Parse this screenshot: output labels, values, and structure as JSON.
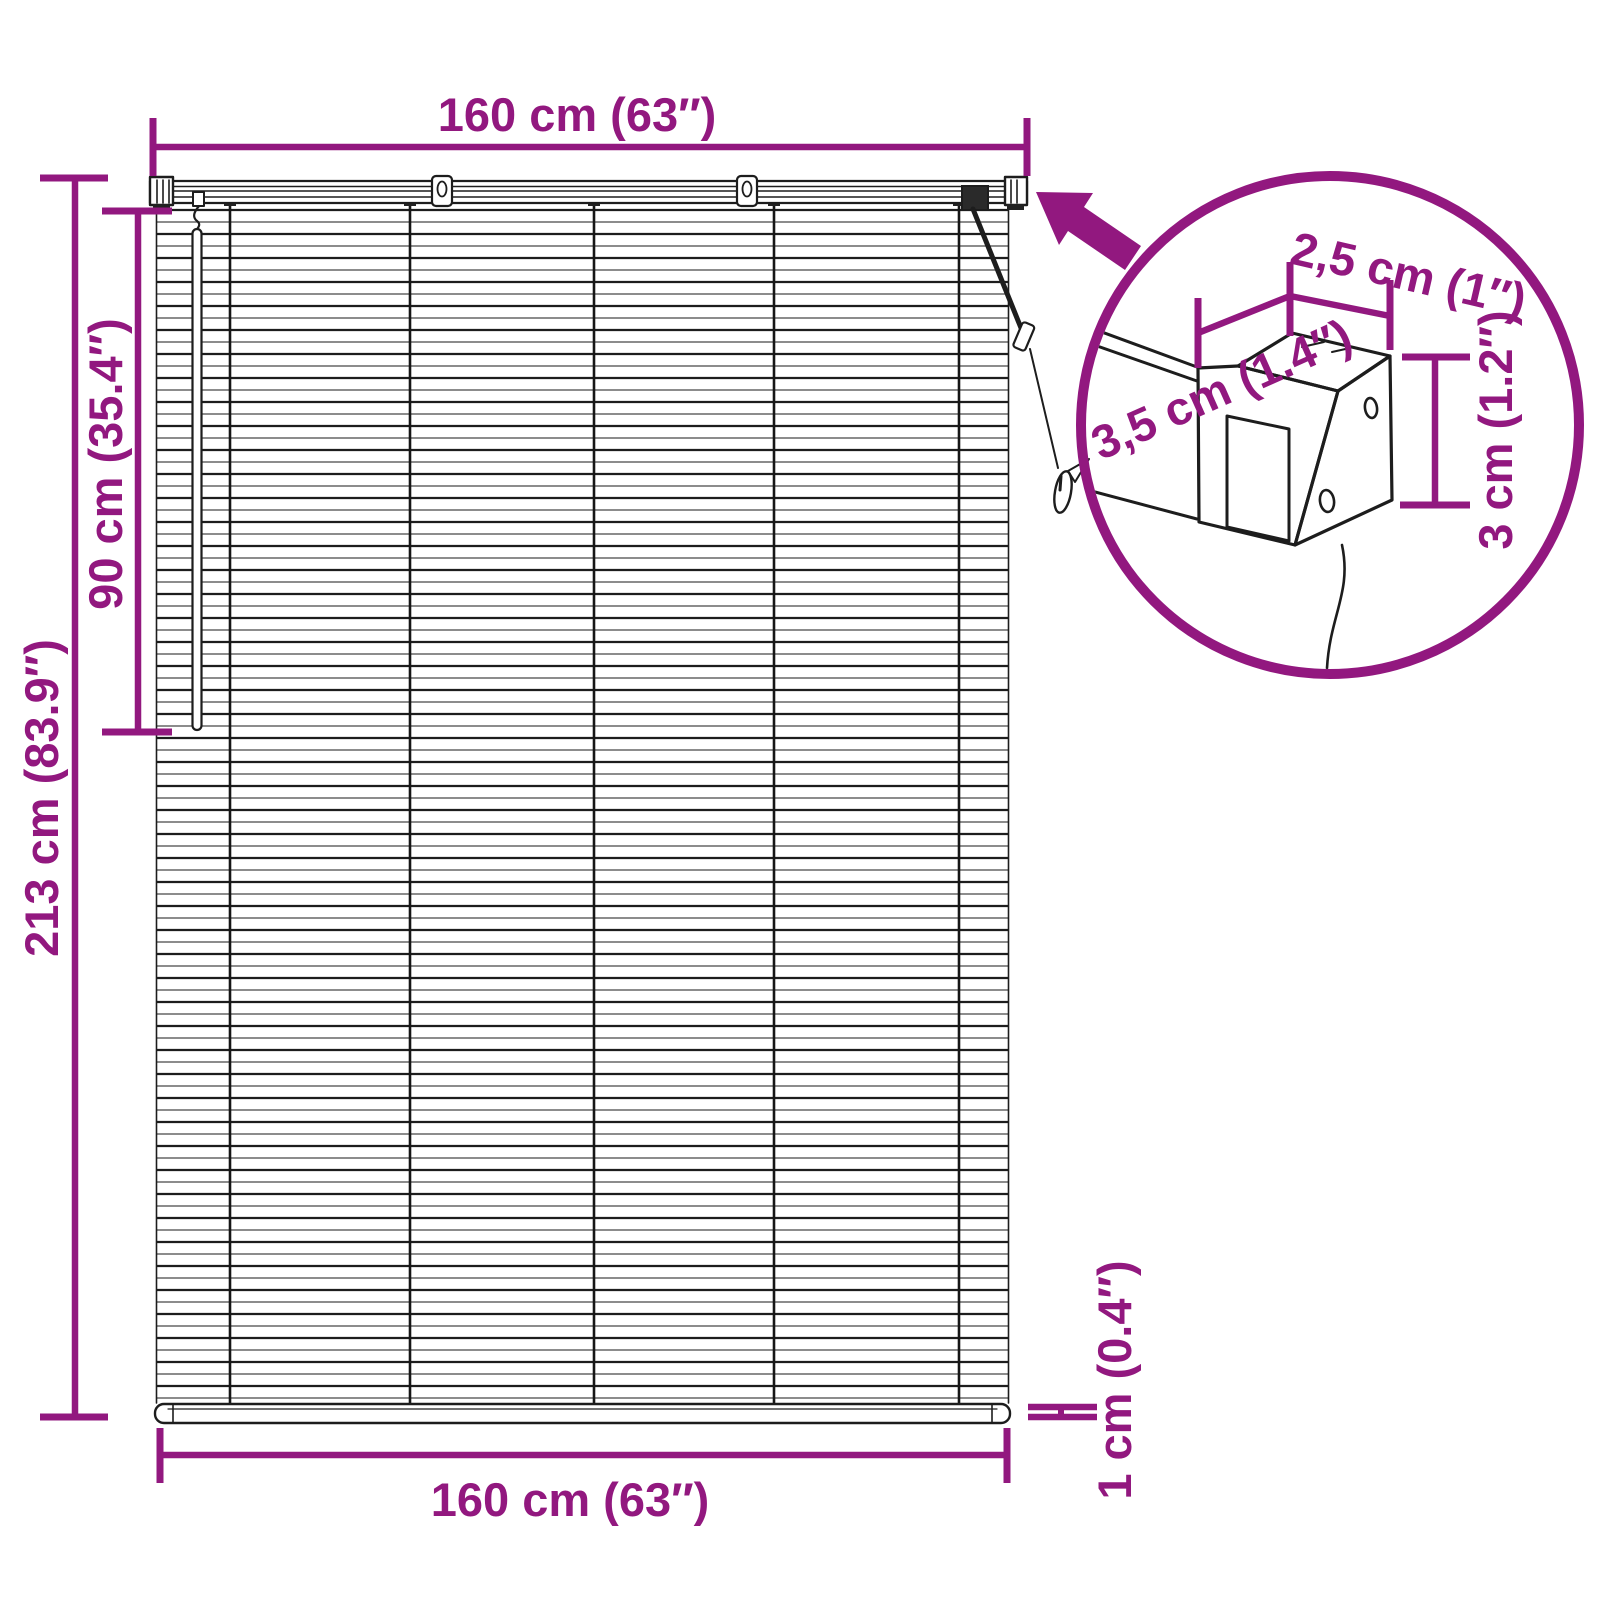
{
  "colors": {
    "accent": "#92187F",
    "line": "#1d1d1d"
  },
  "labels": {
    "top_width": "160 cm (63″)",
    "bottom_width": "160 cm (63″)",
    "total_height": "213 cm (83.9″)",
    "wand_length": "90 cm (35.4″)",
    "bottom_rail_thickness": "1 cm (0.4″)"
  },
  "inset": {
    "bracket_width": "2,5 cm (1″)",
    "bracket_depth": "3,5 cm (1.4″)",
    "bracket_height": "3 cm (1.2″)"
  }
}
